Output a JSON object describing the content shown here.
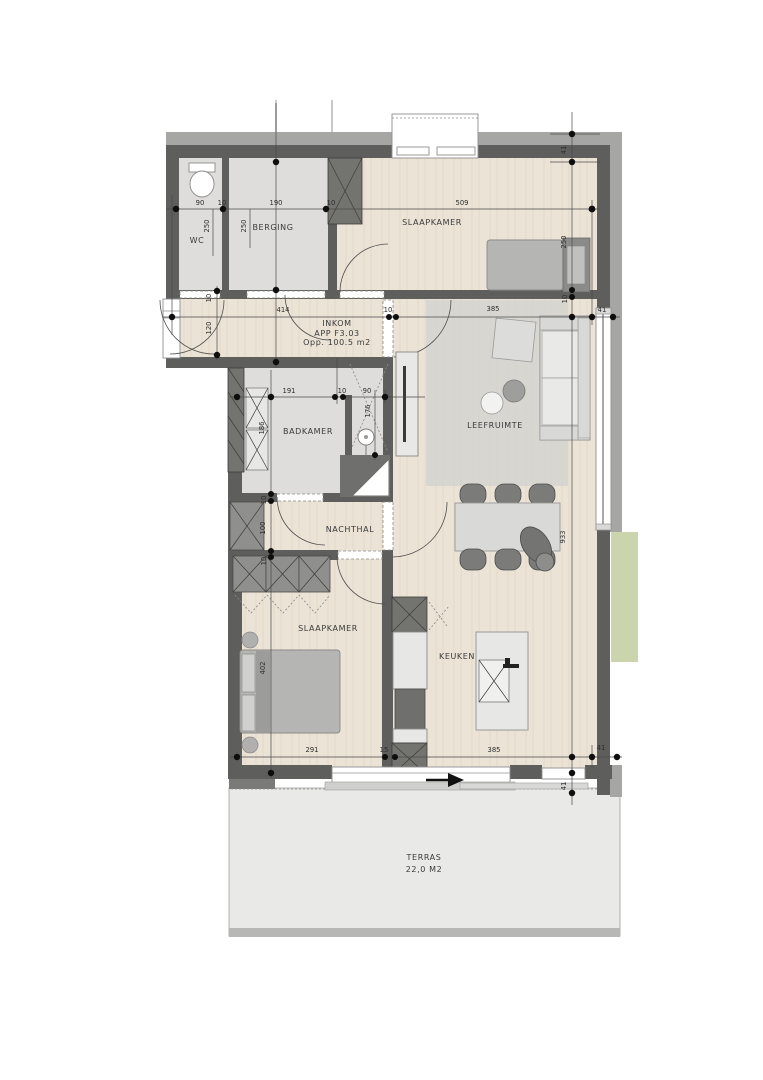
{
  "plan": {
    "inkom_label": "INKOM",
    "apartment_code": "APP F3.03",
    "area_label": "Opp. 100.5 m2"
  },
  "rooms": {
    "wc": "WC",
    "berging": "BERGING",
    "slaapkamer1": "SLAAPKAMER",
    "badkamer": "BADKAMER",
    "leefruimte": "LEEFRUIMTE",
    "nachthal": "NACHTHAL",
    "slaapkamer2": "SLAAPKAMER",
    "keuken": "KEUKEN",
    "terras": "TERRAS",
    "terras_area": "22,0 M2"
  },
  "dims": [
    "90",
    "10",
    "190",
    "10",
    "509",
    "250",
    "250",
    "250",
    "41",
    "10",
    "414",
    "10",
    "10",
    "120",
    "41",
    "385",
    "191",
    "10",
    "90",
    "176",
    "186",
    "100",
    "10",
    "10",
    "933",
    "402",
    "291",
    "15",
    "385",
    "41",
    "41"
  ],
  "colors": {
    "wall": "#5e5e5c",
    "wall_outer_band": "#a6a6a4",
    "wood_floor": "#ebe3d6",
    "tile_floor": "#dedddb",
    "terrace": "#e9e9e8",
    "green_area": "#cad4ad",
    "rug": "#d3d3cf",
    "furniture": "#b5b5b3",
    "dimension_dot": "#0e0e0e"
  }
}
